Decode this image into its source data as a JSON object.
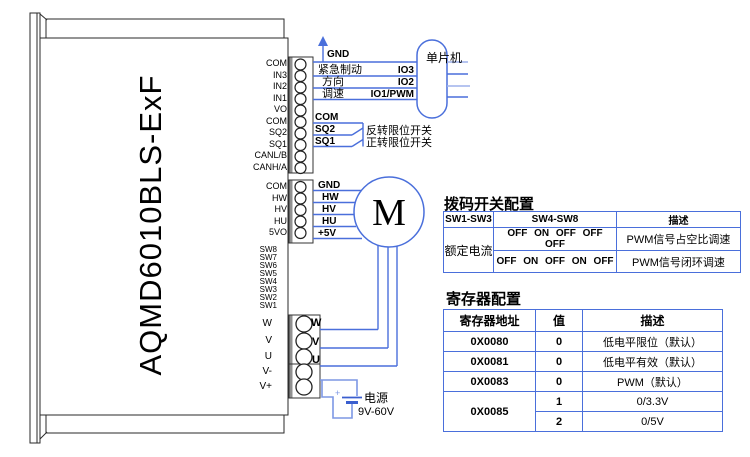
{
  "device": {
    "model": "AQMD6010BLS-ExF"
  },
  "connectors": {
    "block1_pins": [
      "COM",
      "IN3",
      "IN2",
      "IN1",
      "VO",
      "COM",
      "SQ2",
      "SQ1",
      "CANL/B",
      "CANH/A"
    ],
    "block2_pins": [
      "COM",
      "HW",
      "HV",
      "HU",
      "5VO"
    ],
    "dip_pins": [
      "SW8",
      "SW7",
      "SW6",
      "SW5",
      "SW4",
      "SW3",
      "SW2",
      "SW1"
    ],
    "block3_pins": [
      "W",
      "V",
      "U"
    ],
    "block4_pins": [
      "V-",
      "V+"
    ]
  },
  "wiring": {
    "mcu_label": "单片机",
    "gnd_label": "GND",
    "io3_label": "IO3",
    "io2_label": "IO2",
    "io1_label": "IO1/PWM",
    "brake_label": "紧急制动",
    "direction_label": "方向",
    "speed_label": "调速",
    "com_label": "COM",
    "sq2_label": "SQ2",
    "sq1_label": "SQ1",
    "sq2_desc": "反转限位开关",
    "sq1_desc": "正转限位开关",
    "hall_labels": [
      "GND",
      "HW",
      "HV",
      "HU",
      "+5V"
    ],
    "motor_label": "M",
    "phase_labels": [
      "W",
      "V",
      "U"
    ],
    "power_label": "电源",
    "power_range": "9V-60V",
    "power_plus": "+"
  },
  "tables": {
    "dip": {
      "title": "拨码开关配置",
      "headers": [
        "SW1-SW3",
        "SW4-SW8",
        "描述"
      ],
      "row_group": "额定电流",
      "rows": [
        {
          "sw48": "OFF ON OFF OFF OFF",
          "desc": "PWM信号占空比调速"
        },
        {
          "sw48": "OFF ON OFF ON OFF",
          "desc": "PWM信号闭环调速"
        }
      ]
    },
    "registers": {
      "title": "寄存器配置",
      "headers": [
        "寄存器地址",
        "值",
        "描述"
      ],
      "rows": [
        {
          "addr": "0X0080",
          "val": "0",
          "desc": "低电平限位（默认）"
        },
        {
          "addr": "0X0081",
          "val": "0",
          "desc": "低电平有效（默认）"
        },
        {
          "addr": "0X0083",
          "val": "0",
          "desc": "PWM（默认）"
        },
        {
          "addr": "0X0085",
          "val": "1",
          "desc": "0/3.3V"
        },
        {
          "val": "2",
          "desc": "0/5V"
        }
      ]
    }
  }
}
